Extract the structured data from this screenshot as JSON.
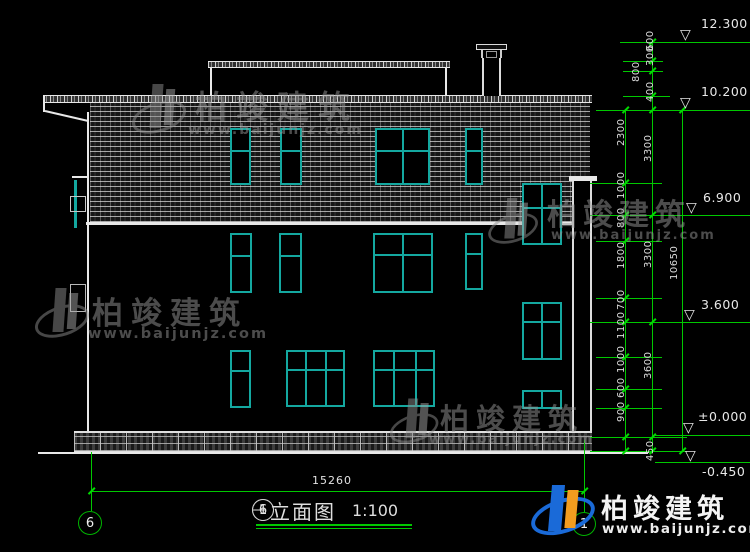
{
  "drawing": {
    "title_axis_start": "6",
    "title_separator": "—",
    "title_axis_end": "1",
    "title_name": "立面图",
    "title_scale": "1:100",
    "grid_bubble_left": "6",
    "grid_bubble_right": "1"
  },
  "brand": {
    "name": "柏竣建筑",
    "url": "www.baijunjz.com"
  },
  "elevations": {
    "roof_top": "12.300",
    "roof": "10.200",
    "level3": "6.900",
    "level2": "3.600",
    "ground": "±0.000",
    "site": "-0.450"
  },
  "dimensions": {
    "total_width": "15260",
    "overall_height": "10650",
    "floor_heights": [
      "3300",
      "3300",
      "3600"
    ],
    "segments": [
      "600",
      "300",
      "800",
      "400",
      "2300",
      "1000",
      "800",
      "1800",
      "700",
      "1100",
      "1000",
      "600",
      "900",
      "450"
    ]
  },
  "colors": {
    "dimension_green": "#00c800",
    "window_teal": "#14a8a0",
    "line_white": "#e8e8e8",
    "background": "#000000"
  }
}
